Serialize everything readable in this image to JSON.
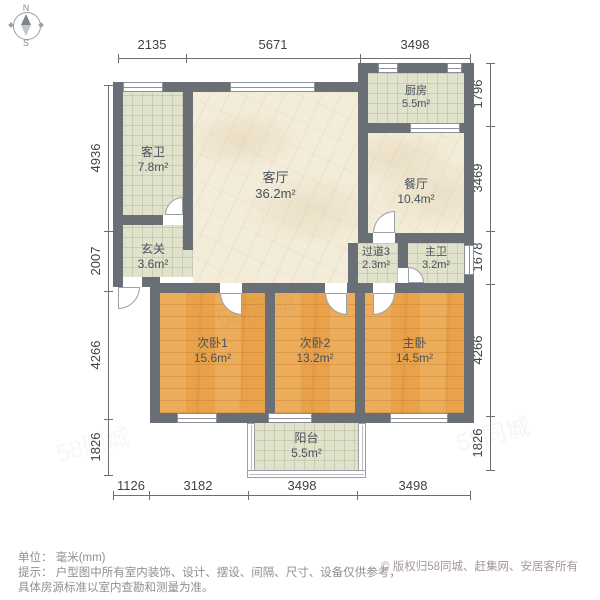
{
  "compass": {
    "north": "N",
    "south": "S"
  },
  "watermark": {
    "text": "58同城"
  },
  "rooms": [
    {
      "name": "客卫",
      "area": "7.8m²"
    },
    {
      "name": "玄关",
      "area": "3.6m²"
    },
    {
      "name": "客厅",
      "area": "36.2m²"
    },
    {
      "name": "厨房",
      "area": "5.5m²"
    },
    {
      "name": "餐厅",
      "area": "10.4m²"
    },
    {
      "name": "过道3",
      "area": "2.3m²"
    },
    {
      "name": "主卫",
      "area": "3.2m²"
    },
    {
      "name": "次卧1",
      "area": "15.6m²"
    },
    {
      "name": "次卧2",
      "area": "13.2m²"
    },
    {
      "name": "主卧",
      "area": "14.5m²"
    },
    {
      "name": "阳台",
      "area": "5.5m²"
    }
  ],
  "dimensions": {
    "top": [
      "2135",
      "5671",
      "3498"
    ],
    "left": [
      "4936",
      "2007",
      "4266",
      "1826"
    ],
    "right": [
      "1796",
      "3469",
      "1678",
      "4266",
      "1826"
    ],
    "bottom": [
      "1126",
      "3182",
      "3498",
      "3498"
    ]
  },
  "notes": {
    "unit": "单位： 毫米(mm)",
    "tip1": "提示： 户型图中所有室内装饰、设计、摆设、间隔、尺寸、设备仅供参考，",
    "tip2": "具体房源标准以室内查勘和测量为准。",
    "copyright": "© 版权归58同城、赶集网、安居客所有"
  },
  "colors": {
    "wall": "#6a6f76",
    "floor_living": "#f3ecd9",
    "floor_tile": "#e0e2cb",
    "floor_bedroom": "#e9a24a",
    "dimension_text": "#3f4346",
    "note_text": "#8f8f8f",
    "copyright_text": "#a59697"
  }
}
